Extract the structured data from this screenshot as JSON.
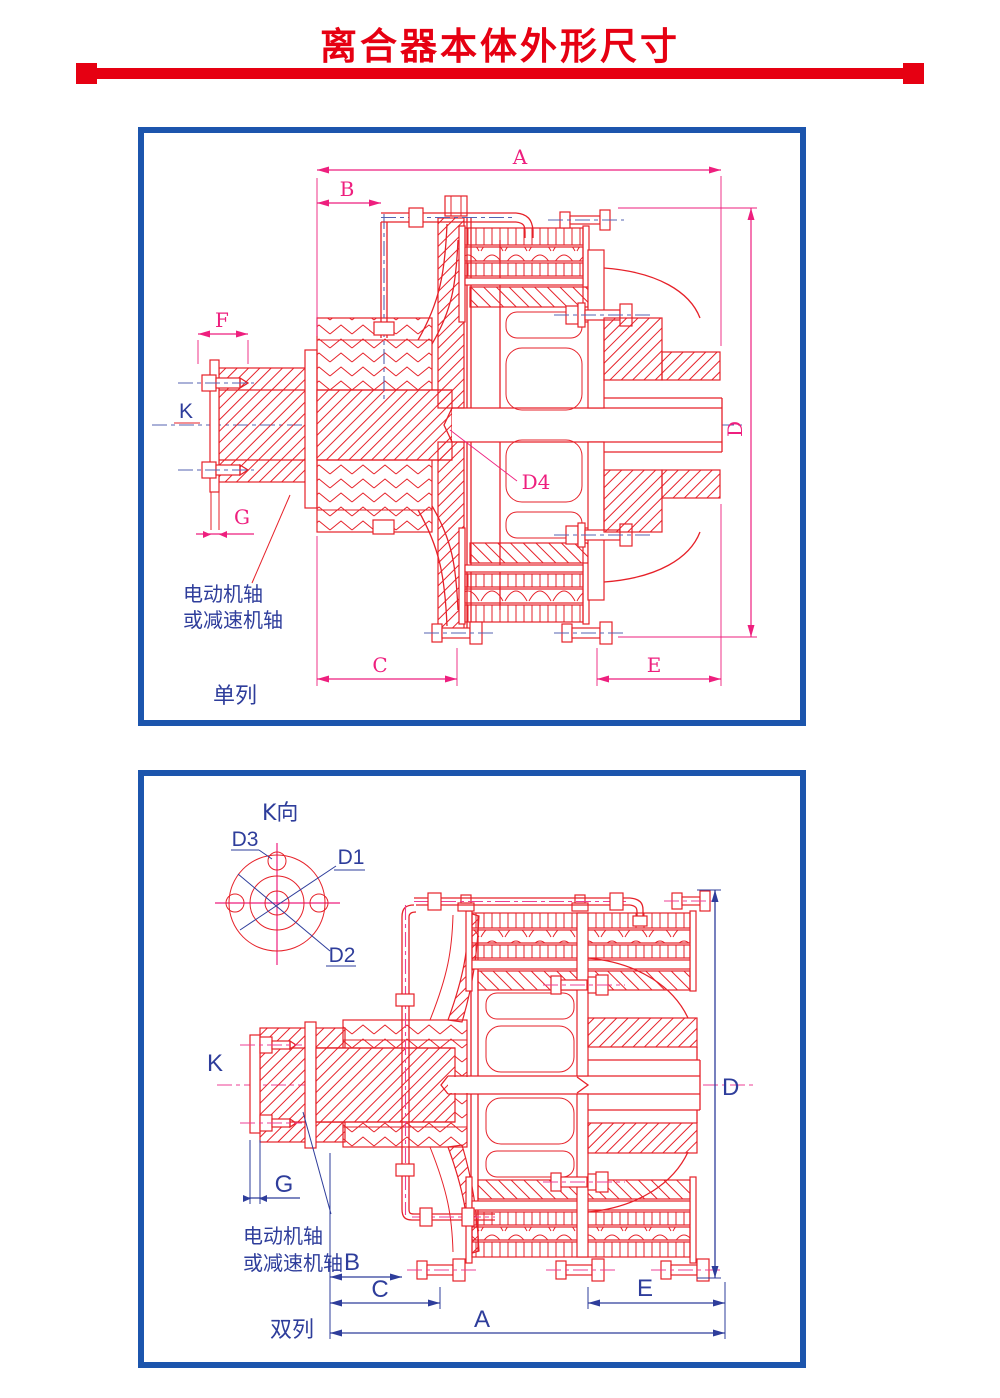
{
  "page": {
    "title": "离合器本体外形尺寸"
  },
  "colors": {
    "title_red": "#e60012",
    "drawing_red": "#e62129",
    "dimension_magenta": "#ee1f7e",
    "dimension_blue": "#2e3d9b",
    "centerline_blue": "#5563b1",
    "centerline_magenta": "#ee3f94",
    "frame_blue": "#1c55ad"
  },
  "drawing1": {
    "caption": "单列",
    "shaft_note_line1": "电动机轴",
    "shaft_note_line2": "或减速机轴",
    "labels": {
      "A": "A",
      "B": "B",
      "C": "C",
      "D": "D",
      "E": "E",
      "F": "F",
      "G": "G",
      "K": "K",
      "D4": "D4"
    }
  },
  "drawing2": {
    "caption": "双列",
    "view_label": "K向",
    "shaft_note_line1": "电动机轴",
    "shaft_note_line2": "或减速机轴",
    "labels": {
      "A": "A",
      "B": "B",
      "C": "C",
      "D": "D",
      "E": "E",
      "G": "G",
      "K": "K",
      "D1": "D1",
      "D2": "D2",
      "D3": "D3"
    }
  }
}
